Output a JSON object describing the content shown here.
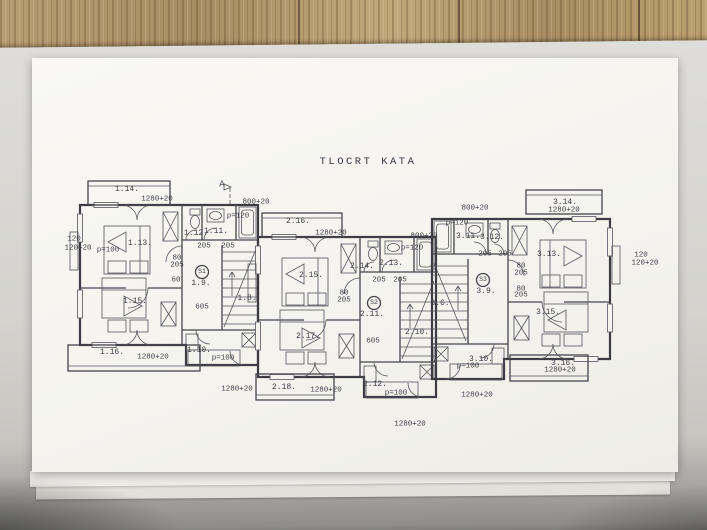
{
  "colors": {
    "wood": "#b2976c",
    "paper": "#f6f5f0",
    "ink": "#3d3d45"
  },
  "plan": {
    "title": "TLOCRT KATA",
    "labels": [
      {
        "t": "A",
        "x": 222,
        "y": 185,
        "k": "section"
      },
      {
        "t": "800+20",
        "x": 256,
        "y": 203,
        "k": "dim"
      },
      {
        "t": "1.14.",
        "x": 127,
        "y": 190,
        "k": "room"
      },
      {
        "t": "1280+20",
        "x": 157,
        "y": 200,
        "k": "dim"
      },
      {
        "t": "120",
        "x": 74,
        "y": 240,
        "k": "dim"
      },
      {
        "t": "120+20",
        "x": 78,
        "y": 249,
        "k": "dim"
      },
      {
        "t": "p=100",
        "x": 108,
        "y": 251,
        "k": "note"
      },
      {
        "t": "1.13.",
        "x": 140,
        "y": 244,
        "k": "room"
      },
      {
        "t": "1.12.",
        "x": 196,
        "y": 234,
        "k": "room"
      },
      {
        "t": "1.11.",
        "x": 216,
        "y": 232,
        "k": "room"
      },
      {
        "t": "p=120",
        "x": 238,
        "y": 217,
        "k": "note"
      },
      {
        "t": "205",
        "x": 204,
        "y": 247,
        "k": "dim"
      },
      {
        "t": "205",
        "x": 228,
        "y": 247,
        "k": "dim"
      },
      {
        "t": "80",
        "x": 177,
        "y": 259,
        "k": "dim"
      },
      {
        "t": "205",
        "x": 177,
        "y": 266,
        "k": "dim"
      },
      {
        "t": "60",
        "x": 176,
        "y": 281,
        "k": "dim"
      },
      {
        "t": "S1",
        "x": 202,
        "y": 272,
        "k": "stair"
      },
      {
        "t": "1.9.",
        "x": 201,
        "y": 284,
        "k": "room"
      },
      {
        "t": "1.8.",
        "x": 247,
        "y": 299,
        "k": "room"
      },
      {
        "t": "1.15.",
        "x": 135,
        "y": 302,
        "k": "room"
      },
      {
        "t": "605",
        "x": 202,
        "y": 308,
        "k": "dim"
      },
      {
        "t": "1.16.",
        "x": 112,
        "y": 353,
        "k": "room"
      },
      {
        "t": "1280+20",
        "x": 153,
        "y": 358,
        "k": "dim"
      },
      {
        "t": "1.10.",
        "x": 199,
        "y": 351,
        "k": "room"
      },
      {
        "t": "p=100",
        "x": 223,
        "y": 359,
        "k": "note"
      },
      {
        "t": "1280+20",
        "x": 237,
        "y": 390,
        "k": "dim"
      },
      {
        "t": "2.16.",
        "x": 298,
        "y": 222,
        "k": "room"
      },
      {
        "t": "1280+20",
        "x": 331,
        "y": 234,
        "k": "dim"
      },
      {
        "t": "800+20",
        "x": 424,
        "y": 237,
        "k": "dim"
      },
      {
        "t": "p=120",
        "x": 412,
        "y": 249,
        "k": "note"
      },
      {
        "t": "2.14.",
        "x": 362,
        "y": 267,
        "k": "room"
      },
      {
        "t": "2.13.",
        "x": 391,
        "y": 264,
        "k": "room"
      },
      {
        "t": "205",
        "x": 379,
        "y": 281,
        "k": "dim"
      },
      {
        "t": "205",
        "x": 400,
        "y": 281,
        "k": "dim"
      },
      {
        "t": "2.15.",
        "x": 311,
        "y": 276,
        "k": "room"
      },
      {
        "t": "80",
        "x": 344,
        "y": 294,
        "k": "dim"
      },
      {
        "t": "205",
        "x": 344,
        "y": 301,
        "k": "dim"
      },
      {
        "t": "S2",
        "x": 374,
        "y": 303,
        "k": "stair"
      },
      {
        "t": "2.11.",
        "x": 372,
        "y": 315,
        "k": "room"
      },
      {
        "t": "605",
        "x": 373,
        "y": 342,
        "k": "dim"
      },
      {
        "t": "2.17.",
        "x": 308,
        "y": 337,
        "k": "room"
      },
      {
        "t": "2.10.",
        "x": 417,
        "y": 333,
        "k": "room"
      },
      {
        "t": "2.18.",
        "x": 284,
        "y": 388,
        "k": "room"
      },
      {
        "t": "1280+20",
        "x": 326,
        "y": 391,
        "k": "dim"
      },
      {
        "t": "2.12.",
        "x": 375,
        "y": 385,
        "k": "room"
      },
      {
        "t": "p=100",
        "x": 396,
        "y": 394,
        "k": "note"
      },
      {
        "t": "1280+20",
        "x": 410,
        "y": 425,
        "k": "dim"
      },
      {
        "t": "800+20",
        "x": 475,
        "y": 209,
        "k": "dim"
      },
      {
        "t": "p=120",
        "x": 457,
        "y": 224,
        "k": "note"
      },
      {
        "t": "3.14.",
        "x": 565,
        "y": 203,
        "k": "room"
      },
      {
        "t": "1280+20",
        "x": 564,
        "y": 211,
        "k": "dim"
      },
      {
        "t": "3.11.",
        "x": 468,
        "y": 237,
        "k": "room"
      },
      {
        "t": "3.12.",
        "x": 492,
        "y": 238,
        "k": "room"
      },
      {
        "t": "205",
        "x": 485,
        "y": 255,
        "k": "dim"
      },
      {
        "t": "205",
        "x": 505,
        "y": 255,
        "k": "dim"
      },
      {
        "t": "3.13.",
        "x": 549,
        "y": 255,
        "k": "room"
      },
      {
        "t": "80",
        "x": 521,
        "y": 267,
        "k": "dim"
      },
      {
        "t": "205",
        "x": 521,
        "y": 274,
        "k": "dim"
      },
      {
        "t": "80",
        "x": 521,
        "y": 290,
        "k": "dim"
      },
      {
        "t": "205",
        "x": 521,
        "y": 296,
        "k": "dim"
      },
      {
        "t": "S3",
        "x": 483,
        "y": 280,
        "k": "stair"
      },
      {
        "t": "3.9.",
        "x": 486,
        "y": 292,
        "k": "room"
      },
      {
        "t": "3.6.",
        "x": 440,
        "y": 304,
        "k": "room"
      },
      {
        "t": "120",
        "x": 641,
        "y": 256,
        "k": "dim"
      },
      {
        "t": "120+20",
        "x": 645,
        "y": 264,
        "k": "dim"
      },
      {
        "t": "3.15.",
        "x": 548,
        "y": 313,
        "k": "room"
      },
      {
        "t": "3.10.",
        "x": 481,
        "y": 360,
        "k": "room"
      },
      {
        "t": "p=100",
        "x": 468,
        "y": 367,
        "k": "note"
      },
      {
        "t": "3.16.",
        "x": 563,
        "y": 364,
        "k": "room"
      },
      {
        "t": "1280+20",
        "x": 560,
        "y": 371,
        "k": "dim"
      },
      {
        "t": "1280+20",
        "x": 477,
        "y": 396,
        "k": "dim"
      }
    ]
  }
}
